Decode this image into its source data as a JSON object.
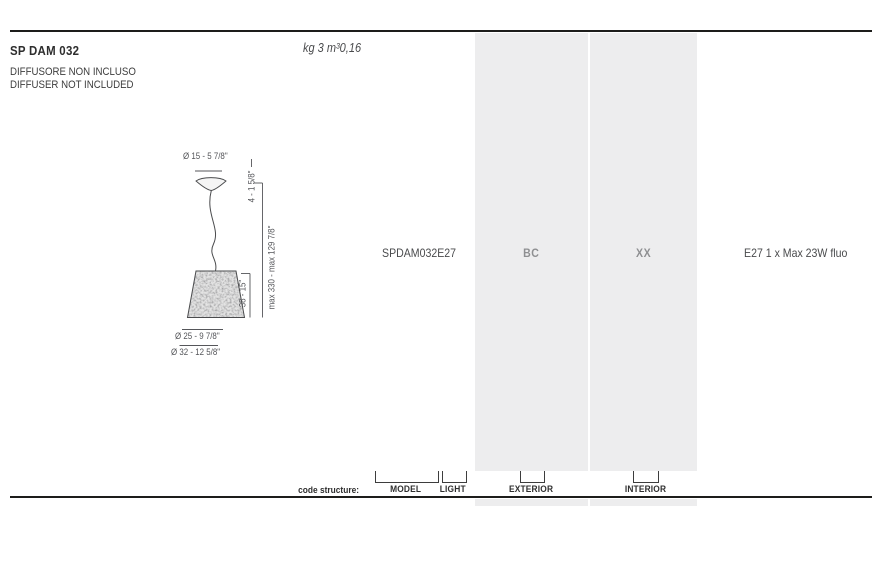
{
  "header": {
    "product_code": "SP DAM 032",
    "note_line1": "DIFFUSORE NON INCLUSO",
    "note_line2": "DIFFUSER NOT INCLUDED",
    "weight_volume": "kg 3 m³0,16"
  },
  "drawing": {
    "canopy_diameter": "Ø 15 - 5 7/8\"",
    "canopy_height": "4 - 1 5/8\"",
    "max_drop": "max 330 - max 129 7/8\"",
    "shade_height": "38 - 15\"",
    "shade_top_diameter": "Ø 25 - 9 7/8\"",
    "shade_bottom_diameter": "Ø 32 - 12 5/8\""
  },
  "spec": {
    "code": "SPDAM032E27",
    "exterior": "BC",
    "interior": "XX",
    "lamping": "E27 1 x Max 23W fluo"
  },
  "code_structure": {
    "caption": "code structure:",
    "model_label": "MODEL",
    "light_label": "LIGHT",
    "exterior_label": "EXTERIOR",
    "interior_label": "INTERIOR"
  },
  "colors": {
    "column_bg": "#ededee",
    "rule": "#1d1d1b",
    "dark_text": "#3d3d3d",
    "muted_text": "#8e8f91"
  }
}
